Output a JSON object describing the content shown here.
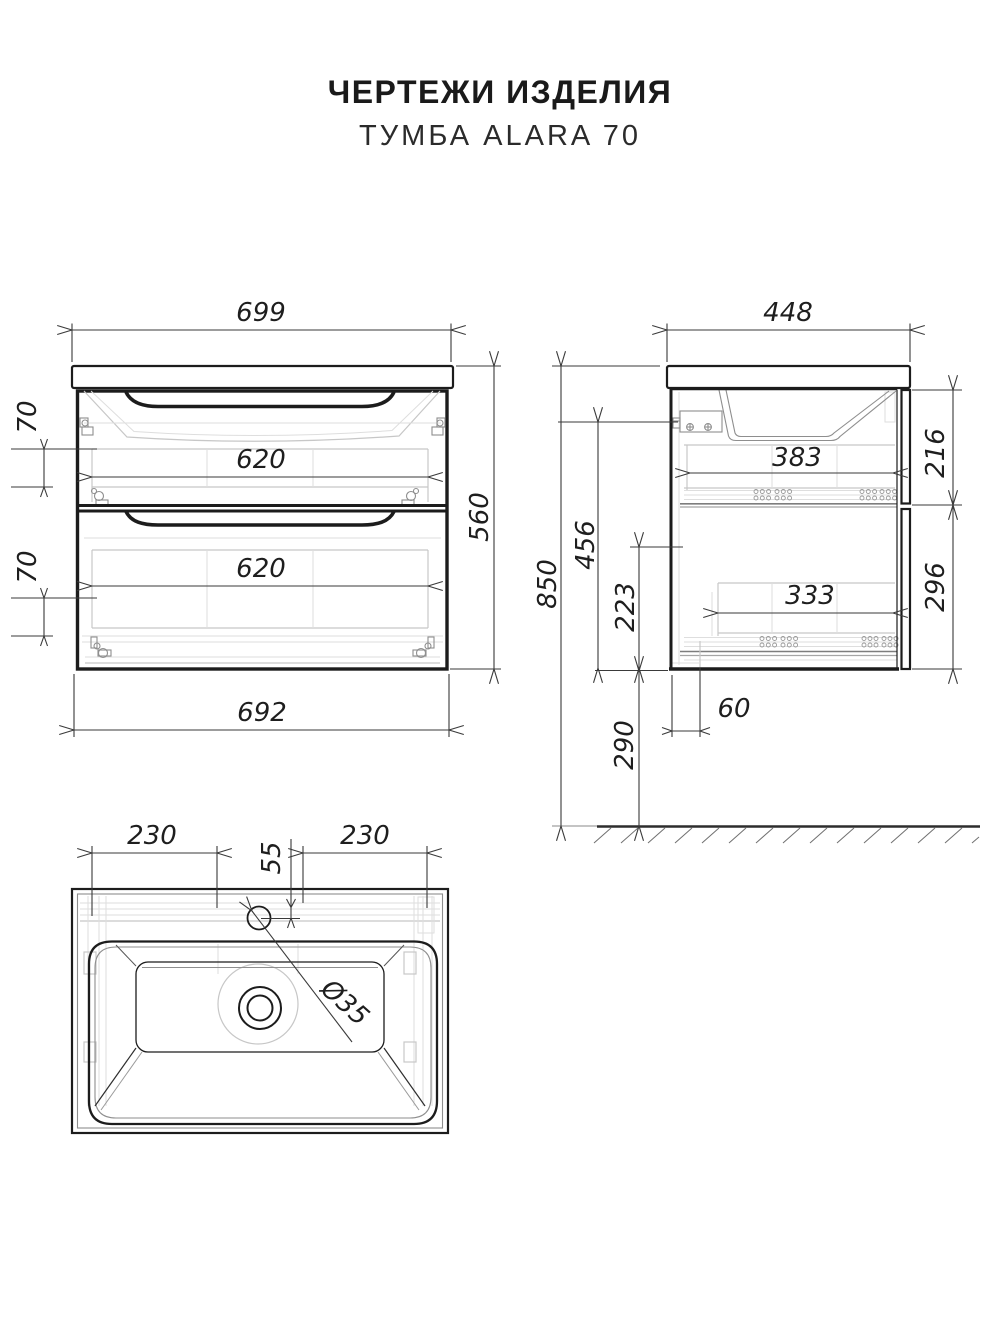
{
  "header": {
    "title": "ЧЕРТЕЖИ ИЗДЕЛИЯ",
    "subtitle": "ТУМБА ALARA 70"
  },
  "front_view": {
    "top_width": "699",
    "opening_width_top": "620",
    "opening_height_top": "70",
    "opening_width_bottom": "620",
    "opening_height_bottom": "70",
    "body_width": "692",
    "height": "560"
  },
  "side_view": {
    "depth": "448",
    "top_drawer_front": "216",
    "top_drawer_depth": "383",
    "bottom_drawer_front": "296",
    "bottom_drawer_depth": "333",
    "interior_height": "456",
    "slide_offset": "223",
    "total_height": "850",
    "floor_clearance": "290",
    "bottom_inset": "60"
  },
  "sink_view": {
    "left_offset": "230",
    "faucet_offset": "55",
    "right_offset": "230",
    "faucet_hole_diameter": "Ø35"
  }
}
